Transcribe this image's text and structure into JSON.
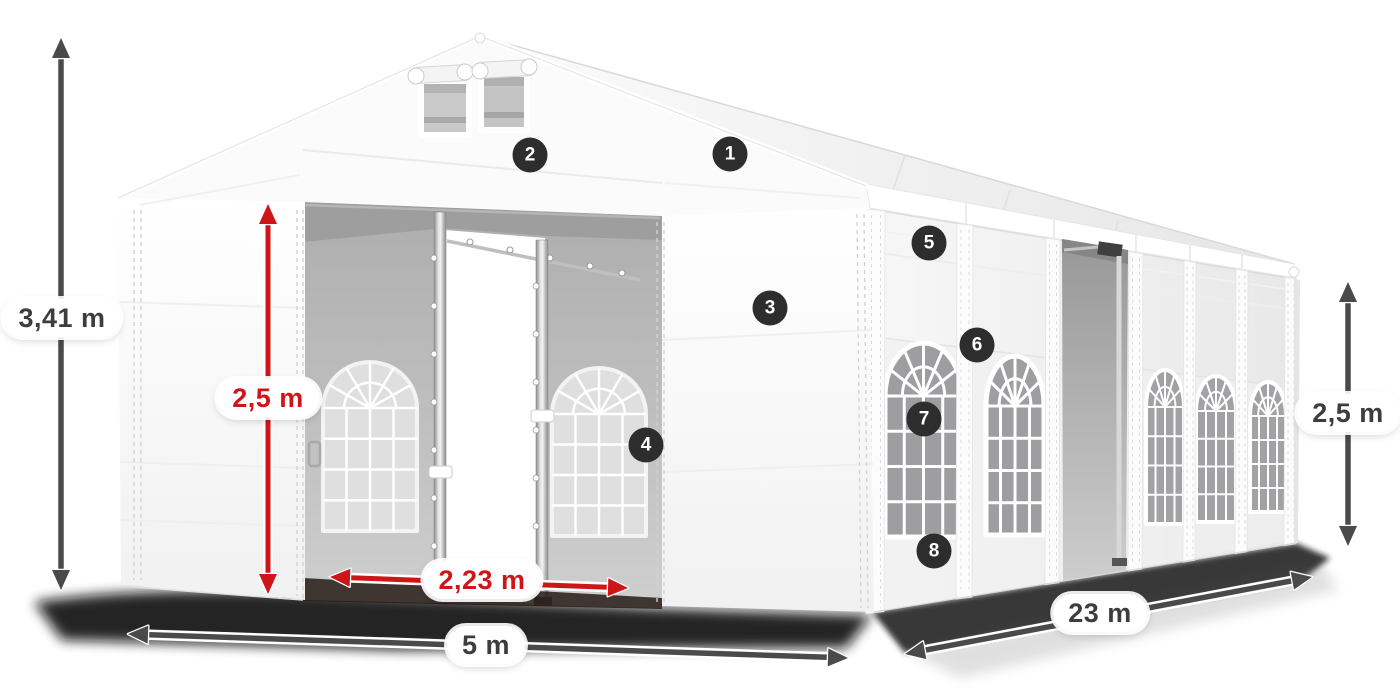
{
  "dimensions": {
    "total_height": {
      "label": "3,41 m"
    },
    "door_height": {
      "label": "2,5 m"
    },
    "door_width": {
      "label": "2,23 m"
    },
    "front_width": {
      "label": "5 m"
    },
    "length": {
      "label": "23 m"
    },
    "side_height": {
      "label": "2,5 m"
    }
  },
  "callouts": [
    "1",
    "2",
    "3",
    "4",
    "5",
    "6",
    "7",
    "8"
  ],
  "colors": {
    "dimension_red": "#ce1619",
    "dimension_gray": "#4a4a4a",
    "badge_background": "#2d2d2d",
    "badge_text": "#ffffff",
    "label_text": "#3d3d3d",
    "label_background": "#ffffff"
  }
}
